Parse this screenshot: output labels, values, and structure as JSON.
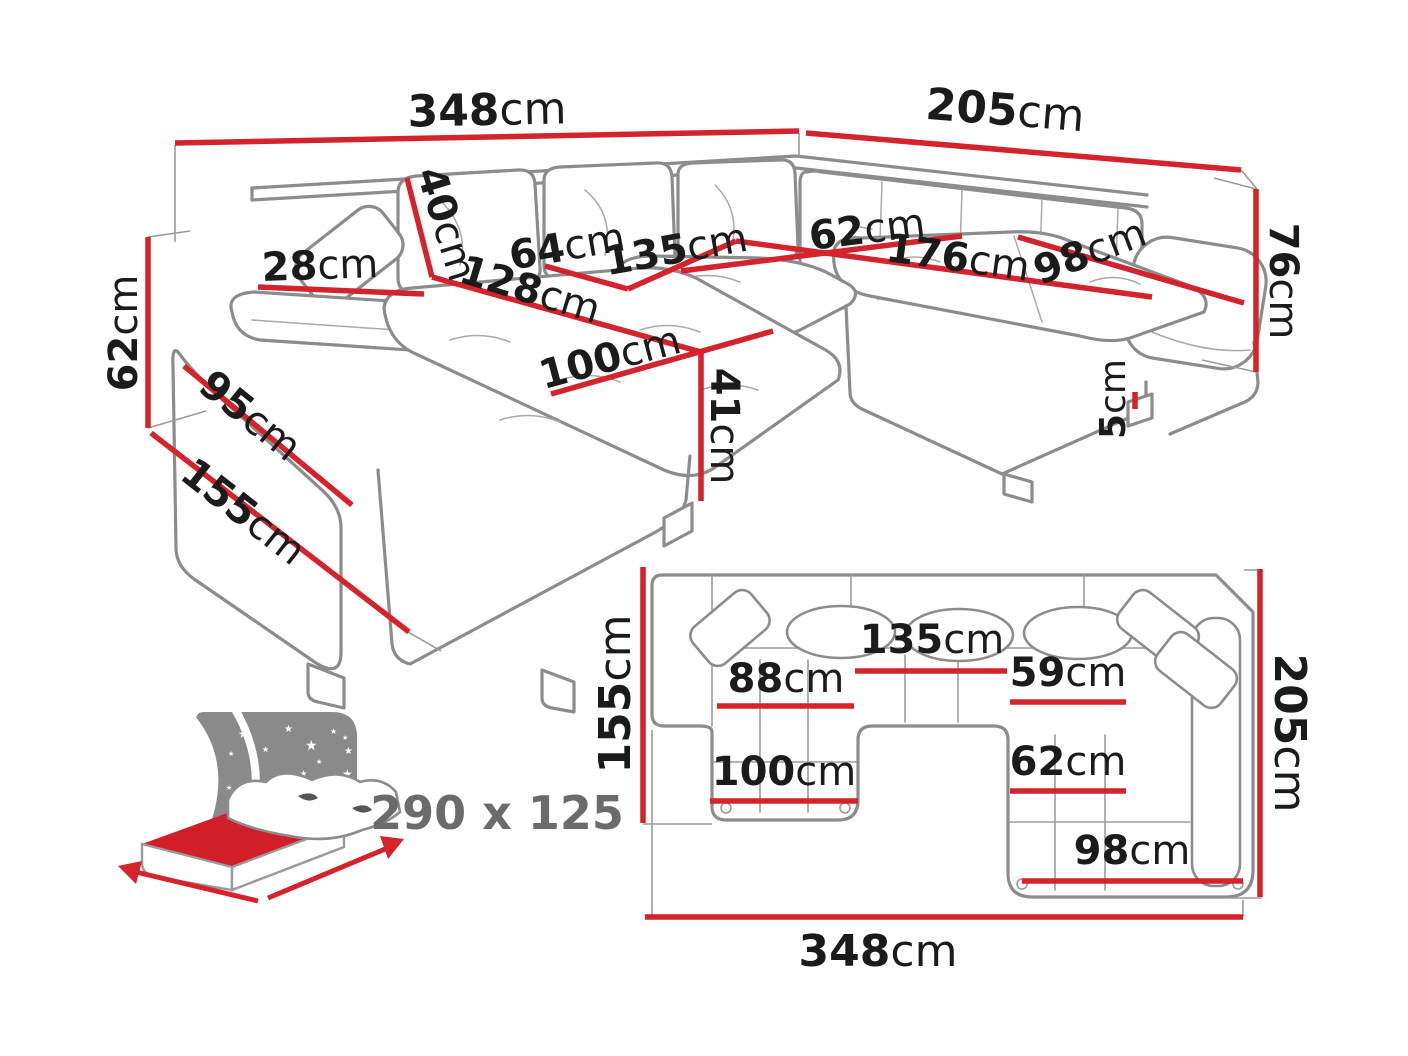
{
  "title": "U-shaped corner sofa-bed dimension diagram",
  "colors": {
    "dimension_line_red": "#d4232a",
    "sofa_outline_gray": "#8c8c8c",
    "label_text_black": "#1b1b1b",
    "bed_headboard_gray": "#8a8a8a",
    "bed_mattress_red": "#d21e28",
    "bed_size_text_gray": "#6b6b6b",
    "background": "#ffffff"
  },
  "icons": {
    "star_glyph": "★"
  },
  "perspective_view": {
    "description": "3D line drawing of U-shaped sectional sofa with red dimension lines",
    "dimensions": [
      {
        "value": "348",
        "unit": "cm"
      },
      {
        "value": "205",
        "unit": "cm"
      },
      {
        "value": "76",
        "unit": "cm"
      },
      {
        "value": "5",
        "unit": "cm"
      },
      {
        "value": "62",
        "unit": "cm"
      },
      {
        "value": "155",
        "unit": "cm"
      },
      {
        "value": "95",
        "unit": "cm"
      },
      {
        "value": "28",
        "unit": "cm"
      },
      {
        "value": "40",
        "unit": "cm"
      },
      {
        "value": "64",
        "unit": "cm"
      },
      {
        "value": "135",
        "unit": "cm"
      },
      {
        "value": "62",
        "unit": "cm"
      },
      {
        "value": "176",
        "unit": "cm"
      },
      {
        "value": "98",
        "unit": "cm"
      },
      {
        "value": "128",
        "unit": "cm"
      },
      {
        "value": "100",
        "unit": "cm"
      },
      {
        "value": "41",
        "unit": "cm"
      }
    ]
  },
  "plan_view": {
    "description": "Top-down plan of U-shaped sectional sofa with red dimension lines",
    "dimensions": [
      {
        "value": "155",
        "unit": "cm"
      },
      {
        "value": "88",
        "unit": "cm"
      },
      {
        "value": "135",
        "unit": "cm"
      },
      {
        "value": "59",
        "unit": "cm"
      },
      {
        "value": "62",
        "unit": "cm"
      },
      {
        "value": "100",
        "unit": "cm"
      },
      {
        "value": "98",
        "unit": "cm"
      },
      {
        "value": "205",
        "unit": "cm"
      },
      {
        "value": "348",
        "unit": "cm"
      }
    ]
  },
  "sleeping_area": {
    "label": "290 x 125"
  }
}
